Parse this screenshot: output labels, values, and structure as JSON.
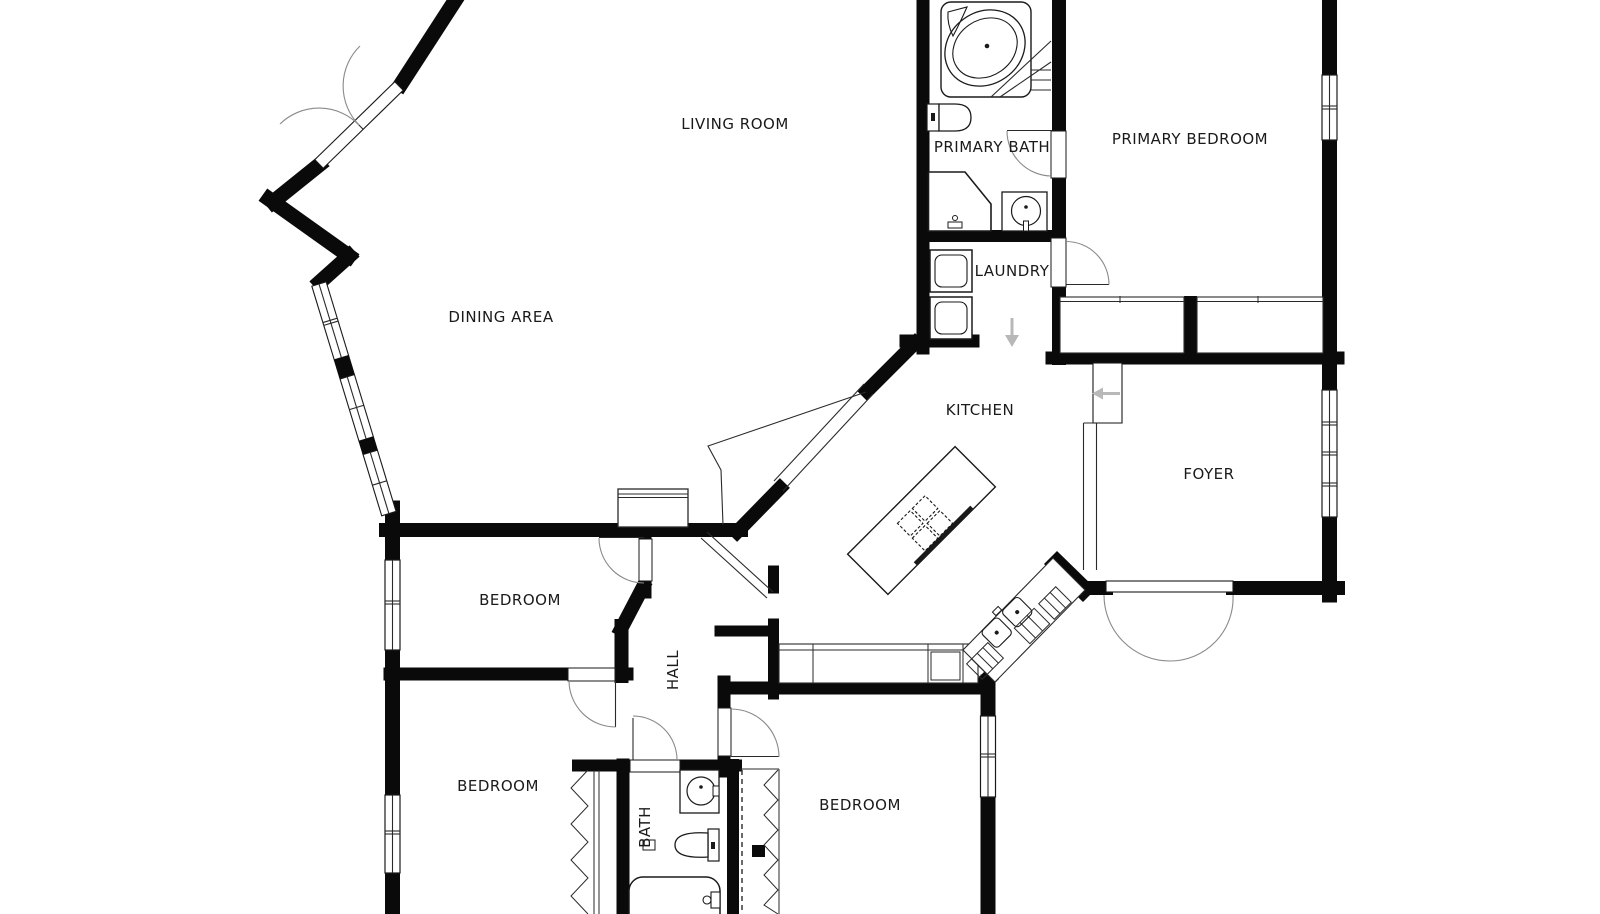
{
  "plan": {
    "title": "single-level residential floor plan",
    "colors": {
      "background": "#ffffff",
      "walls": "#0a0a0a",
      "lines": "#2a2a2a",
      "door_arcs": "#8a8a8a",
      "stair_arrows": "#b8b8b8",
      "label_text": "#1a1a1a"
    },
    "rooms": [
      {
        "id": "living-room",
        "label": "LIVING ROOM"
      },
      {
        "id": "dining-area",
        "label": "DINING AREA"
      },
      {
        "id": "primary-bath",
        "label": "PRIMARY BATH"
      },
      {
        "id": "primary-bedroom",
        "label": "PRIMARY BEDROOM"
      },
      {
        "id": "laundry",
        "label": "LAUNDRY"
      },
      {
        "id": "kitchen",
        "label": "KITCHEN"
      },
      {
        "id": "foyer",
        "label": "FOYER"
      },
      {
        "id": "bedroom-1",
        "label": "BEDROOM"
      },
      {
        "id": "bedroom-2",
        "label": "BEDROOM"
      },
      {
        "id": "bedroom-3",
        "label": "BEDROOM"
      },
      {
        "id": "hall",
        "label": "HALL"
      },
      {
        "id": "bath",
        "label": "BATH"
      }
    ],
    "fixtures": [
      "corner-bathtub",
      "toilet",
      "shower",
      "pedestal-sink",
      "washer",
      "dryer",
      "kitchen-island",
      "cooktop",
      "counter",
      "dishwasher",
      "double-sink",
      "bathtub",
      "vanity-sink",
      "stairs",
      "front-double-door",
      "french-doors",
      "sliding-closet",
      "wardrobe-rail"
    ]
  }
}
